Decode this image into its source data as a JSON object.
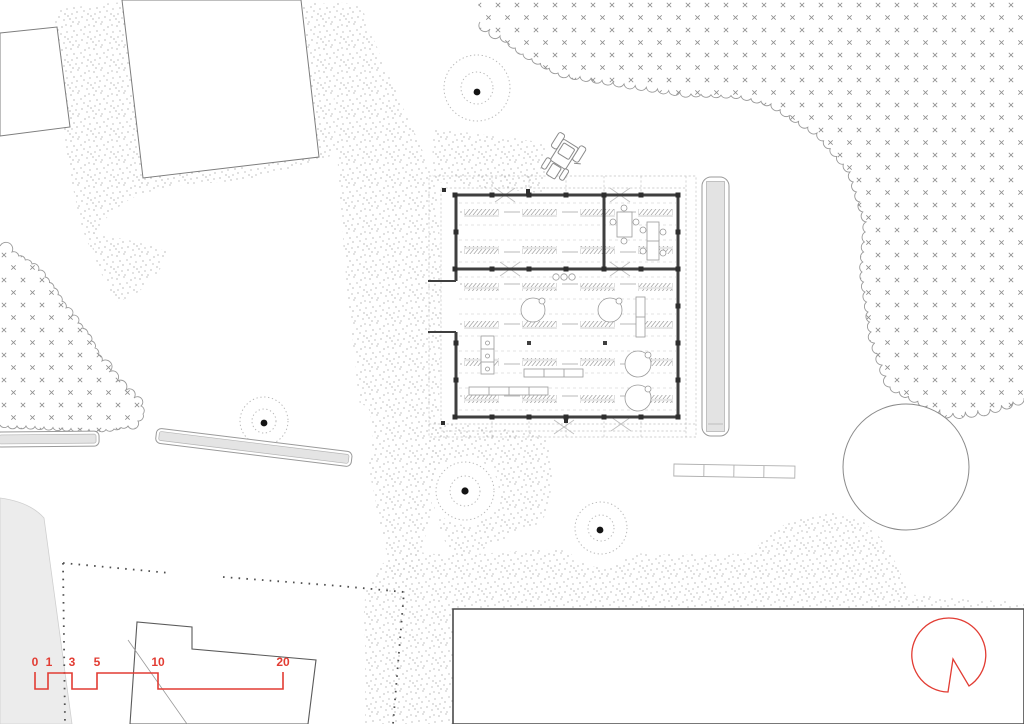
{
  "drawing": {
    "type": "architectural-site-plan",
    "visible_text_note": "only scale bar numerals are rendered on the plan"
  },
  "scale_bar": {
    "labels": [
      "0",
      "1",
      "3",
      "5",
      "10",
      "20"
    ]
  },
  "colors": {
    "accent_red": "#e23c33",
    "wall_dark": "#3f3f3f",
    "outline_grey": "#8f8f8f",
    "canopy_edge": "#9a9a9a",
    "stipple_dot": "#9c9c9c",
    "bench_fill": "#e4e4e4",
    "paper": "#ffffff"
  },
  "icons": {
    "north_arrow": "north-arrow-icon",
    "tractor": "tractor-icon",
    "tree_dot": "tree-trunk-dot",
    "tree_ring": "tree-canopy-ring",
    "forest": "forest-canopy",
    "fence": "fence-dotted-line"
  }
}
